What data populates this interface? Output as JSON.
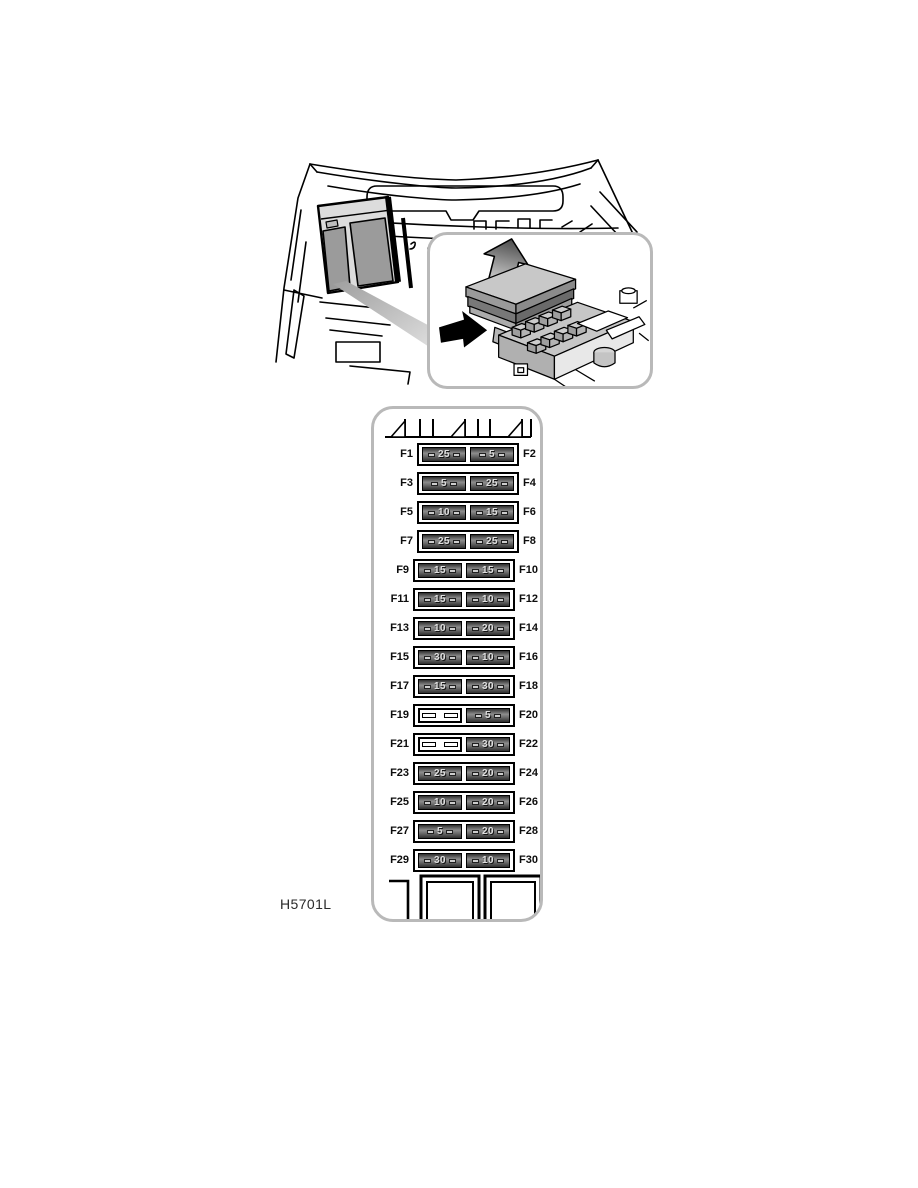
{
  "figure": {
    "code": "H5701L"
  },
  "colors": {
    "panel_border": "#b9b9b9",
    "fuse_edge": "#2e2e2e",
    "fuse_body": "#8d8d8d",
    "fuse_text": "#dedede",
    "line_art": "#000000"
  },
  "icons": {
    "lift_cover_arrow": "up-arrow",
    "location_arrow": "right-arrow"
  },
  "fuse_panel": {
    "rows": [
      {
        "left_label": "F1",
        "left_amp": "25",
        "right_amp": "5",
        "right_label": "F2"
      },
      {
        "left_label": "F3",
        "left_amp": "5",
        "right_amp": "25",
        "right_label": "F4"
      },
      {
        "left_label": "F5",
        "left_amp": "10",
        "right_amp": "15",
        "right_label": "F6"
      },
      {
        "left_label": "F7",
        "left_amp": "25",
        "right_amp": "25",
        "right_label": "F8"
      },
      {
        "left_label": "F9",
        "left_amp": "15",
        "right_amp": "15",
        "right_label": "F10"
      },
      {
        "left_label": "F11",
        "left_amp": "15",
        "right_amp": "10",
        "right_label": "F12"
      },
      {
        "left_label": "F13",
        "left_amp": "10",
        "right_amp": "20",
        "right_label": "F14"
      },
      {
        "left_label": "F15",
        "left_amp": "30",
        "right_amp": "10",
        "right_label": "F16"
      },
      {
        "left_label": "F17",
        "left_amp": "15",
        "right_amp": "30",
        "right_label": "F18"
      },
      {
        "left_label": "F19",
        "left_amp": null,
        "right_amp": "5",
        "right_label": "F20"
      },
      {
        "left_label": "F21",
        "left_amp": null,
        "right_amp": "30",
        "right_label": "F22"
      },
      {
        "left_label": "F23",
        "left_amp": "25",
        "right_amp": "20",
        "right_label": "F24"
      },
      {
        "left_label": "F25",
        "left_amp": "10",
        "right_amp": "20",
        "right_label": "F26"
      },
      {
        "left_label": "F27",
        "left_amp": "5",
        "right_amp": "20",
        "right_label": "F28"
      },
      {
        "left_label": "F29",
        "left_amp": "30",
        "right_amp": "10",
        "right_label": "F30"
      }
    ]
  }
}
